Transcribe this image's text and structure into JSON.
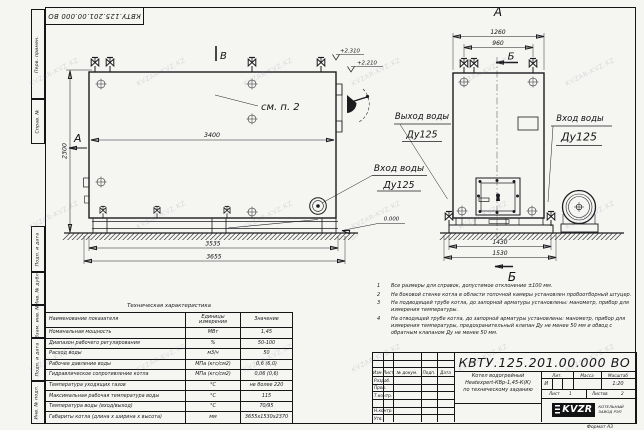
{
  "watermark": {
    "text": "KVZAR-KVZ.KZ"
  },
  "frame": {
    "doc_number_top": "КВТУ.125.201.00.000  ВО",
    "side_labels": [
      "Перв. примен.",
      "Справ. №",
      "Подп. и дата",
      "Инв. № дубл.",
      "Взам. инв. №",
      "Подп. и дата",
      "Инв. № подл."
    ],
    "format_label": "Формат  А3"
  },
  "views": {
    "side": {
      "section_a": "А",
      "section_b": "В",
      "see_note": "см. п. 2",
      "dim_length": "3400",
      "dim_height": "2300",
      "level_top": "+2.310",
      "level_mid": "+2.210",
      "dim_skid": "3535",
      "dim_overall": "3655",
      "inlet_line1": "Вход воды",
      "inlet_line2": "Ду125"
    },
    "front": {
      "title": "А",
      "section_b_top": "Б",
      "section_b_bottom": "Б",
      "dim_width": "1260",
      "dim_valves": "960",
      "dim_base": "1430",
      "dim_base_overall": "1530",
      "outlet_line1": "Выход воды",
      "outlet_line2": "Ду125",
      "inlet_line1": "Вход воды",
      "inlet_line2": "Ду125",
      "level_zero": "0.000"
    }
  },
  "notes": {
    "items": [
      {
        "num": "1",
        "text": "Все размеры для справок, допустимое отклонение ±100 мм."
      },
      {
        "num": "2",
        "text": "На боковой стенке котла в области топочной камеры установлен пробоотборный штуцер."
      },
      {
        "num": "3",
        "text": "На подводящей трубе котла, до запорной арматуры установлены: манометр, прибор для измерения температуры."
      },
      {
        "num": "4",
        "text": "На отводящей трубе котла, до запорной арматуры установлены: манометр, прибор для измерения температуры, предохранительный клапан Ду не менее 50 мм и обвод с обратным клапаном Ду не менее 50 мм."
      }
    ]
  },
  "tech_table": {
    "title": "Техническая характеристика",
    "headers": [
      "Наименование показателя",
      "Единицы измерения",
      "Значение"
    ],
    "rows": [
      {
        "name": "Номинальная мощность",
        "unit": "МВт",
        "value": "1,45"
      },
      {
        "name": "Диапазон рабочего регулирования",
        "unit": "%",
        "value": "50-100"
      },
      {
        "name": "Расход воды",
        "unit": "м3/ч",
        "value": "50"
      },
      {
        "name": "Рабочее давление воды",
        "unit": "МПа (кгс/см2)",
        "value": "0,6 (6,0)"
      },
      {
        "name": "Гидравлическое сопротивление котла",
        "unit": "МПа (кгс/см2)",
        "value": "0,06 (0,6)"
      },
      {
        "name": "Температура уходящих газов",
        "unit": "°С",
        "value": "не более 220"
      },
      {
        "name": "Максимальная рабочая температура воды",
        "unit": "°С",
        "value": "115"
      },
      {
        "name": "Температура воды (вход/выход)",
        "unit": "°С",
        "value": "70/95"
      },
      {
        "name": "Габариты котла (длина х ширина х высота)",
        "unit": "мм",
        "value": "3655х1530х2370"
      }
    ]
  },
  "title_block": {
    "doc_number": "КВТУ.125.201.00.000  ВО",
    "product_line1": "Котел водогрейный",
    "product_line2": "Heatexpert-КВр-1,45-К(К)",
    "product_line3": "по техническому заданию",
    "sig_headers": [
      "Изм.",
      "Лист",
      "№ докум.",
      "Подп.",
      "Дата"
    ],
    "sig_rows": [
      "Разраб.",
      "Пров.",
      "Т.контр.",
      "",
      "Н.контр.",
      "Утв."
    ],
    "lit_label": "Лит.",
    "lit_value": "И",
    "mass_label": "Масса",
    "scale_label": "Масштаб",
    "scale_value": "1:20",
    "sheet_label": "Лист",
    "sheet_value": "1",
    "sheets_label": "Листов",
    "sheets_value": "2",
    "logo_text": "KVZR",
    "company_line1": "КОТЕЛЬНЫЙ",
    "company_line2": "ЗАВОД РЭП"
  }
}
